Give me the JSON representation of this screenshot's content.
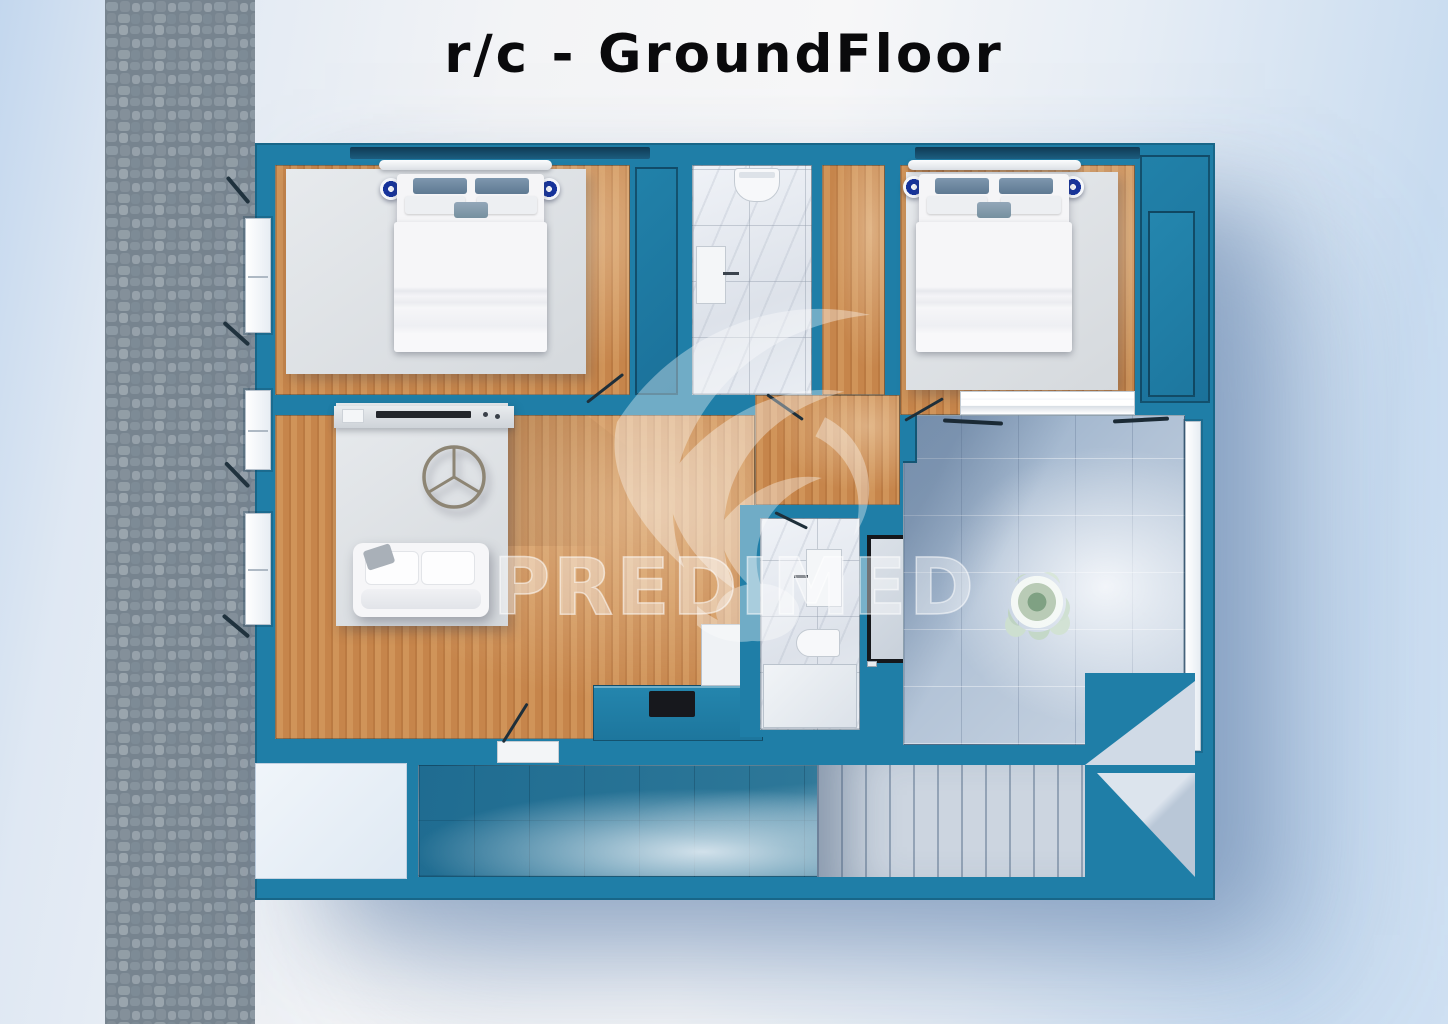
{
  "title": "r/c - GroundFloor",
  "watermark": {
    "text": "PREDIMED",
    "logo_icon": "bird-logo-icon"
  },
  "colors": {
    "wall_teal": "#1F7EA7",
    "wood_floor": "#CA8950",
    "marble_tile": "#E6EAF0",
    "terrace_tile": "#AFC2D6",
    "shadow_tile": "#27718F",
    "rug_gray": "#DDE0E4",
    "lamp_navy": "#16339B",
    "stone_path": "#8D99A3",
    "background_blue": "#CBDCEF"
  }
}
